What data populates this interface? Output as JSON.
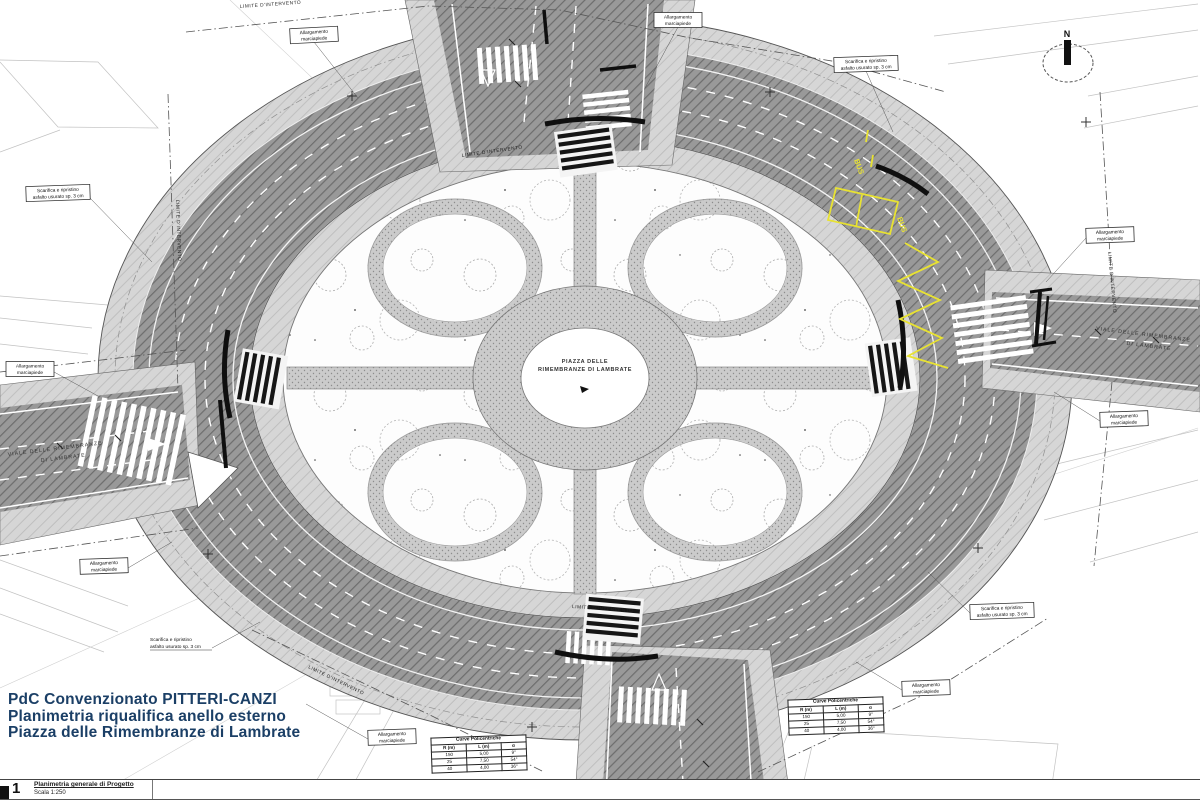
{
  "title_block": {
    "line1": "PdC Convenzionato PITTERI-CANZI",
    "line2": "Planimetria riqualifica anello esterno",
    "line3": "Piazza delle Rimembranze di Lambrate"
  },
  "footer": {
    "sheet_number": "1",
    "caption": "Planimetria generale di Progetto",
    "scale": "Scala 1:250"
  },
  "compass": {
    "north": "N"
  },
  "roundabout": {
    "center_line1": "PIAZZA DELLE",
    "center_line2": "RIMEMBRANZE DI LAMBRATE"
  },
  "streets": {
    "viale_line1": "VIALE DELLE RIMEMBRANZE",
    "viale_line2": "DI LAMBRATE"
  },
  "boundary_label": "LIMITE D'INTERVENTO",
  "annotations": {
    "allargamento_line1": "Allargamento",
    "allargamento_line2": "marciapiede",
    "scarifica_line1": "Scarifica e ripristino",
    "scarifica_line2": "asfalto usurato sp. 3 cm"
  },
  "road_markings": {
    "bus": "BUS"
  },
  "curve_table": {
    "title": "Curve Policentriche",
    "headers": [
      "R (m)",
      "L (m)",
      "α"
    ],
    "rows": [
      [
        "150",
        "5,00",
        "9°"
      ],
      [
        "25",
        "7,50",
        "54°"
      ],
      [
        "40",
        "4,00",
        "36°"
      ]
    ]
  },
  "colors": {
    "title_text": "#1b3f66",
    "marking_yellow": "#e8e232",
    "asphalt": "#999999",
    "sidewalk": "#d6d6d6",
    "park": "#fdfdfd"
  }
}
